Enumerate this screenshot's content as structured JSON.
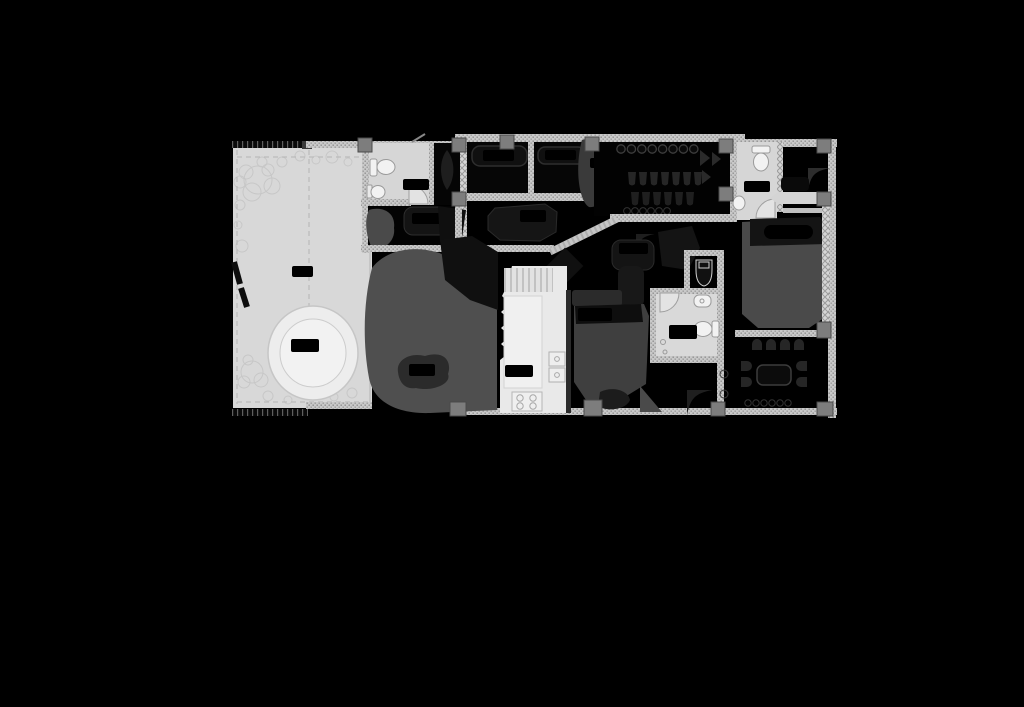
{
  "scene": {
    "kind": "architectural-floor-plan",
    "note": "Monochrome apartment floor plan centered on black canvas; all room labels are illegible solid black pills",
    "background": "#000000"
  },
  "palette": {
    "canvas": "#000000",
    "terrace_floor": "#d8d8d8",
    "pool_outer": "#ededed",
    "pool_inner": "#f2f2f2",
    "bathroom_floor": "#d6d6d6",
    "kitchen_floor": "#e9e9e9",
    "wall_hatch": "#c9c9c9",
    "wall_dot": "#8d8d8d",
    "column_gray": "#7d7d7d",
    "living_gray": "#4f4f4f",
    "bed_gray": "#454545",
    "furniture_dark": "#1c1c1c",
    "label_pill": "#000000",
    "fixture_fill": "#f2f2f2",
    "fixture_stroke": "#9a9a9a"
  },
  "rooms": {
    "terrace": {
      "name": "terrace-garden"
    },
    "pool": {
      "name": "plunge-pool"
    },
    "bath1": {
      "name": "bathroom-top-left"
    },
    "foyer": {
      "name": "dark-foyer"
    },
    "bedroomA": {
      "name": "bedroom-a"
    },
    "bedroomB": {
      "name": "bedroom-b"
    },
    "closet": {
      "name": "walk-in-closet"
    },
    "bath2": {
      "name": "bathroom-top-right"
    },
    "bedroomR": {
      "name": "bedroom-right"
    },
    "dining": {
      "name": "dining-nook"
    },
    "hall": {
      "name": "hall"
    },
    "wc": {
      "name": "wc"
    },
    "bath3": {
      "name": "bathroom-center"
    },
    "bedroomC": {
      "name": "bedroom-center"
    },
    "kitchen": {
      "name": "kitchen"
    },
    "living": {
      "name": "living-room"
    }
  },
  "labels": {
    "style": "redacted-black-pill",
    "count": 16,
    "text": ""
  }
}
